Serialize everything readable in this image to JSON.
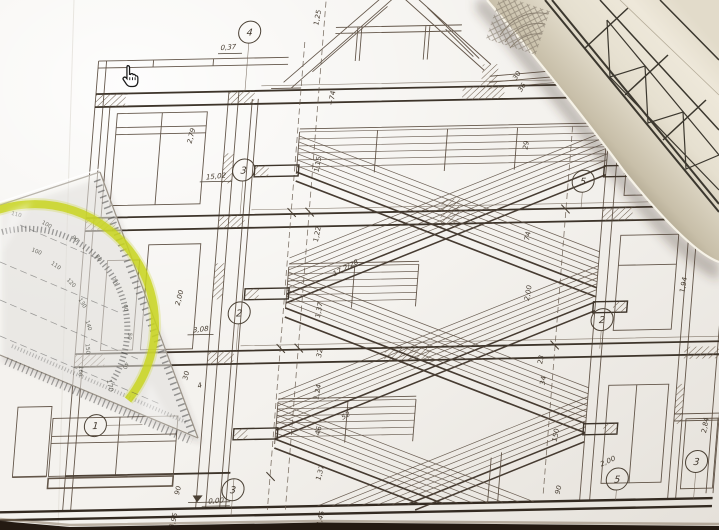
{
  "scene": {
    "kind": "photo of architectural section blueprint with set square, paper roll and cursor"
  },
  "cursor": {
    "type": "hand-pointer"
  },
  "colors": {
    "paper": "#f4f2ee",
    "line": "#57493c",
    "heavy_line": "#3d342a",
    "roll_light": "#ece6d8",
    "roll_dark": "#a89f8a",
    "protractor_arc": "#c8d41e",
    "photo_edge": "#241a12"
  },
  "blueprint": {
    "circles": [
      "4",
      "3",
      "2",
      "1",
      "3",
      "5",
      "2",
      "5",
      "3"
    ],
    "dims": [
      "0,37",
      "1,25",
      "2,79",
      "15,02",
      "1,15",
      "1,22",
      "2,00",
      "3,08",
      "1,37",
      "32",
      "1,24",
      "52",
      "46",
      "1,37",
      "90",
      "0,00",
      "3,95",
      "3,45",
      "74",
      "2,00",
      "1,94",
      "23",
      "34",
      "2,84",
      "150",
      "2,00",
      "90",
      "29",
      "+74",
      "30",
      "36",
      "17,2/28",
      "30",
      "4"
    ]
  },
  "setsquare": {
    "outer_degrees": [
      "110",
      "100",
      "90",
      "80",
      "70",
      "60",
      "50",
      "40"
    ],
    "inner_degrees": [
      "100",
      "110",
      "120",
      "130",
      "140",
      "150",
      "160",
      "170"
    ]
  }
}
